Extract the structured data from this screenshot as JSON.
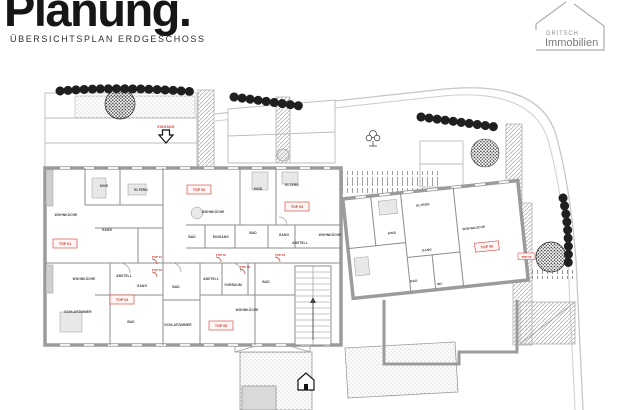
{
  "header": {
    "title": "Planung.",
    "subtitle": "ÜBERSICHTSPLAN ERDGESCHOSS"
  },
  "logo": {
    "line1": "GRITSCH",
    "line2": "Immobilien"
  },
  "colors": {
    "accent_red": "#cf3a2e",
    "wall_gray": "#9b9b9b",
    "partition_gray": "#8c8c8c",
    "street_gray": "#c7c7c7",
    "hedge_black": "#1f1f1f",
    "title_black": "#161616"
  },
  "icons": {
    "entrance-arrow": "hollow down-arrow",
    "house": "house pictogram",
    "tree": "stippled circle",
    "hedge": "scalloped dark band",
    "stairs": "tread lines with arrow"
  },
  "plan": {
    "entrance": {
      "label": "EINGANG"
    },
    "rooms": [
      {
        "label": "WOHNKÜCHE"
      },
      {
        "label": "KIND"
      },
      {
        "label": "ELTERN"
      },
      {
        "label": "GANG"
      },
      {
        "label": "BAD"
      },
      {
        "label": "WOHNKÜCHE"
      },
      {
        "label": "KIND"
      },
      {
        "label": "ELTERN"
      },
      {
        "label": "BAD"
      },
      {
        "label": "EINGANG"
      },
      {
        "label": "GANG"
      },
      {
        "label": "ABSTELL"
      },
      {
        "label": "WOHNKÜCHE"
      },
      {
        "label": "KIND"
      },
      {
        "label": "ELTERN"
      },
      {
        "label": "GANG"
      },
      {
        "label": "WOHNKÜCHE"
      },
      {
        "label": "WOHNKÜCHE"
      },
      {
        "label": "ABSTELL"
      },
      {
        "label": "GANG"
      },
      {
        "label": "SCHLAFZIMMER"
      },
      {
        "label": "BAD"
      },
      {
        "label": "BAD"
      },
      {
        "label": "SCHLAFZIMMER"
      },
      {
        "label": "ABSTELL"
      },
      {
        "label": "VORRAUM"
      },
      {
        "label": "BAD"
      },
      {
        "label": "WOHNKÜCHE"
      },
      {
        "label": "BAD"
      },
      {
        "label": "WC"
      }
    ],
    "units": [
      {
        "label": "TOP 01"
      },
      {
        "label": "TOP 02"
      },
      {
        "label": "TOP 03"
      },
      {
        "label": "TOP 04"
      },
      {
        "label": "TOP 05"
      },
      {
        "label": "TOP 06"
      },
      {
        "label": "TOP 06"
      }
    ],
    "doors": [
      {
        "label": "TOP 01"
      },
      {
        "label": "TOP 04"
      },
      {
        "label": "TOP 02"
      },
      {
        "label": "TOP 03"
      },
      {
        "label": "TOP 05"
      }
    ]
  }
}
